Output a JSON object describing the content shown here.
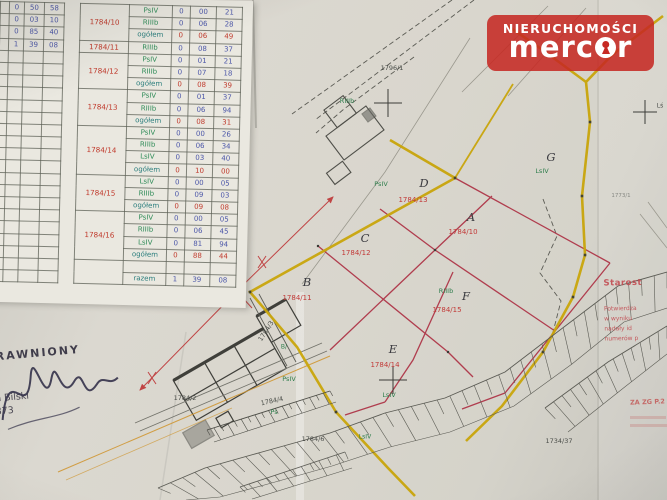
{
  "colors": {
    "boundary_yellow": "#c9a50b",
    "parcel_red": "#b03d4e",
    "label_red": "#c23a38",
    "label_green": "#2e7d4c",
    "table_blue": "#4a55a8",
    "table_red": "#c0392b",
    "table_green": "#2e8b57",
    "table_teal": "#2b7e7d",
    "logo_red": "#c62a24"
  },
  "logo": {
    "brand_top": "NIERUCHOMOŚCI",
    "brand_word_start": "merc",
    "brand_word_end": "r"
  },
  "left_table": {
    "rows": [
      [
        "0",
        "50",
        "58"
      ],
      [
        "0",
        "03",
        "10"
      ],
      [
        "0",
        "85",
        "40"
      ],
      [
        "1",
        "39",
        "08"
      ]
    ],
    "empty_rows": 19
  },
  "right_table": {
    "groups": [
      {
        "parcel": "1784/10",
        "rows": [
          {
            "cls": "PsIV",
            "v": [
              "0",
              "00",
              "21"
            ]
          },
          {
            "cls": "RIIIb",
            "v": [
              "0",
              "06",
              "28"
            ]
          },
          {
            "cls": "ogółem",
            "v": [
              "0",
              "06",
              "49"
            ]
          }
        ]
      },
      {
        "parcel": "1784/11",
        "rows": [
          {
            "cls": "RIIIb",
            "v": [
              "0",
              "08",
              "37"
            ]
          }
        ]
      },
      {
        "parcel": "1784/12",
        "rows": [
          {
            "cls": "PsIV",
            "v": [
              "0",
              "01",
              "21"
            ]
          },
          {
            "cls": "RIIIb",
            "v": [
              "0",
              "07",
              "18"
            ]
          },
          {
            "cls": "ogółem",
            "v": [
              "0",
              "08",
              "39"
            ]
          }
        ]
      },
      {
        "parcel": "1784/13",
        "rows": [
          {
            "cls": "PsIV",
            "v": [
              "0",
              "01",
              "37"
            ]
          },
          {
            "cls": "RIIIb",
            "v": [
              "0",
              "06",
              "94"
            ]
          },
          {
            "cls": "ogółem",
            "v": [
              "0",
              "08",
              "31"
            ]
          }
        ]
      },
      {
        "parcel": "1784/14",
        "rows": [
          {
            "cls": "PsIV",
            "v": [
              "0",
              "00",
              "26"
            ]
          },
          {
            "cls": "RIIIb",
            "v": [
              "0",
              "06",
              "34"
            ]
          },
          {
            "cls": "LsIV",
            "v": [
              "0",
              "03",
              "40"
            ]
          },
          {
            "cls": "ogółem",
            "v": [
              "0",
              "10",
              "00"
            ]
          }
        ]
      },
      {
        "parcel": "1784/15",
        "rows": [
          {
            "cls": "LsIV",
            "v": [
              "0",
              "00",
              "05"
            ]
          },
          {
            "cls": "RIIIb",
            "v": [
              "0",
              "09",
              "03"
            ]
          },
          {
            "cls": "ogółem",
            "v": [
              "0",
              "09",
              "08"
            ]
          }
        ]
      },
      {
        "parcel": "1784/16",
        "rows": [
          {
            "cls": "PsIV",
            "v": [
              "0",
              "00",
              "05"
            ]
          },
          {
            "cls": "RIIIb",
            "v": [
              "0",
              "06",
              "45"
            ]
          },
          {
            "cls": "LsIV",
            "v": [
              "0",
              "81",
              "94"
            ]
          },
          {
            "cls": "ogółem",
            "v": [
              "0",
              "88",
              "44"
            ]
          }
        ]
      }
    ],
    "footer": {
      "label": "razem",
      "v": [
        "1",
        "39",
        "08"
      ]
    }
  },
  "map": {
    "labels": [
      {
        "t": "1784/13",
        "x": 413,
        "y": 200,
        "c": "red"
      },
      {
        "t": "D",
        "x": 424,
        "y": 183,
        "c": "hand"
      },
      {
        "t": "1784/10",
        "x": 463,
        "y": 232,
        "c": "red"
      },
      {
        "t": "A",
        "x": 471,
        "y": 217,
        "c": "hand"
      },
      {
        "t": "1784/12",
        "x": 356,
        "y": 253,
        "c": "red"
      },
      {
        "t": "C",
        "x": 365,
        "y": 238,
        "c": "hand"
      },
      {
        "t": "1784/11",
        "x": 297,
        "y": 298,
        "c": "red"
      },
      {
        "t": "B",
        "x": 307,
        "y": 282,
        "c": "hand"
      },
      {
        "t": "1784/15",
        "x": 447,
        "y": 310,
        "c": "red"
      },
      {
        "t": "F",
        "x": 466,
        "y": 296,
        "c": "hand"
      },
      {
        "t": "1784/14",
        "x": 385,
        "y": 365,
        "c": "red"
      },
      {
        "t": "E",
        "x": 393,
        "y": 349,
        "c": "hand"
      },
      {
        "t": "G",
        "x": 551,
        "y": 157,
        "c": "hand"
      },
      {
        "t": "RIIIb",
        "x": 347,
        "y": 101,
        "c": "grn"
      },
      {
        "t": "PsIV",
        "x": 381,
        "y": 184,
        "c": "grn"
      },
      {
        "t": "RIIIb",
        "x": 446,
        "y": 291,
        "c": "grn"
      },
      {
        "t": "LsIV",
        "x": 389,
        "y": 395,
        "c": "grn"
      },
      {
        "t": "LsIV",
        "x": 542,
        "y": 171,
        "c": "grn"
      },
      {
        "t": "PsIV",
        "x": 289,
        "y": 379,
        "c": "grn"
      },
      {
        "t": "B/",
        "x": 284,
        "y": 347,
        "c": "grn",
        "s": 6
      },
      {
        "t": "Ps",
        "x": 274,
        "y": 412,
        "c": "grn"
      },
      {
        "t": "LsIV",
        "x": 365,
        "y": 437,
        "c": "grn",
        "s": 6
      },
      {
        "t": "1796/1",
        "x": 392,
        "y": 68,
        "c": "blk"
      },
      {
        "t": "1784/2",
        "x": 185,
        "y": 398,
        "c": "blk"
      },
      {
        "t": "1784/3",
        "x": 266,
        "y": 331,
        "c": "blk",
        "r": -57
      },
      {
        "t": "1784/4",
        "x": 272,
        "y": 401,
        "c": "blk",
        "r": -12
      },
      {
        "t": "1784/6",
        "x": 313,
        "y": 439,
        "c": "blk"
      },
      {
        "t": "1734/37",
        "x": 559,
        "y": 441,
        "c": "blk"
      },
      {
        "t": "Lś",
        "x": 660,
        "y": 106,
        "c": "blk",
        "s": 6
      },
      {
        "t": "1773/1",
        "x": 621,
        "y": 196,
        "c": "micro"
      }
    ],
    "slope_bands": [
      {
        "top": [
          [
            667,
            272
          ],
          [
            618,
            286
          ],
          [
            560,
            330
          ],
          [
            505,
            372
          ],
          [
            445,
            398
          ],
          [
            385,
            413
          ],
          [
            330,
            433
          ],
          [
            262,
            452
          ],
          [
            205,
            468
          ],
          [
            158,
            488
          ]
        ],
        "bottom": [
          [
            667,
            308
          ],
          [
            624,
            322
          ],
          [
            572,
            364
          ],
          [
            514,
            406
          ],
          [
            450,
            432
          ],
          [
            390,
            447
          ],
          [
            332,
            466
          ],
          [
            268,
            484
          ],
          [
            220,
            497
          ],
          [
            186,
            500
          ]
        ],
        "n": 42
      },
      {
        "top": [
          [
            545,
            408
          ],
          [
            608,
            362
          ],
          [
            667,
            326
          ]
        ],
        "bottom": [
          [
            568,
            432
          ],
          [
            626,
            386
          ],
          [
            667,
            354
          ]
        ],
        "n": 14
      },
      {
        "top": [
          [
            207,
            430
          ],
          [
            330,
            391
          ]
        ],
        "bottom": [
          [
            214,
            442
          ],
          [
            336,
            402
          ]
        ],
        "n": 18,
        "color": "#4c4c46"
      },
      {
        "top": [
          [
            345,
            452
          ],
          [
            240,
            487
          ]
        ],
        "bottom": [
          [
            352,
            468
          ],
          [
            252,
            499
          ]
        ],
        "n": 12
      }
    ]
  },
  "stamp": {
    "line1": "RAWNIONY",
    "line2": "iech Bilski",
    "line3": "050 873"
  },
  "right_stamp": {
    "lines": [
      "Starost",
      "Potwierdza",
      "w wyniku",
      "nadały id",
      "numerów p"
    ],
    "corner": "ZA ZG P.2"
  }
}
